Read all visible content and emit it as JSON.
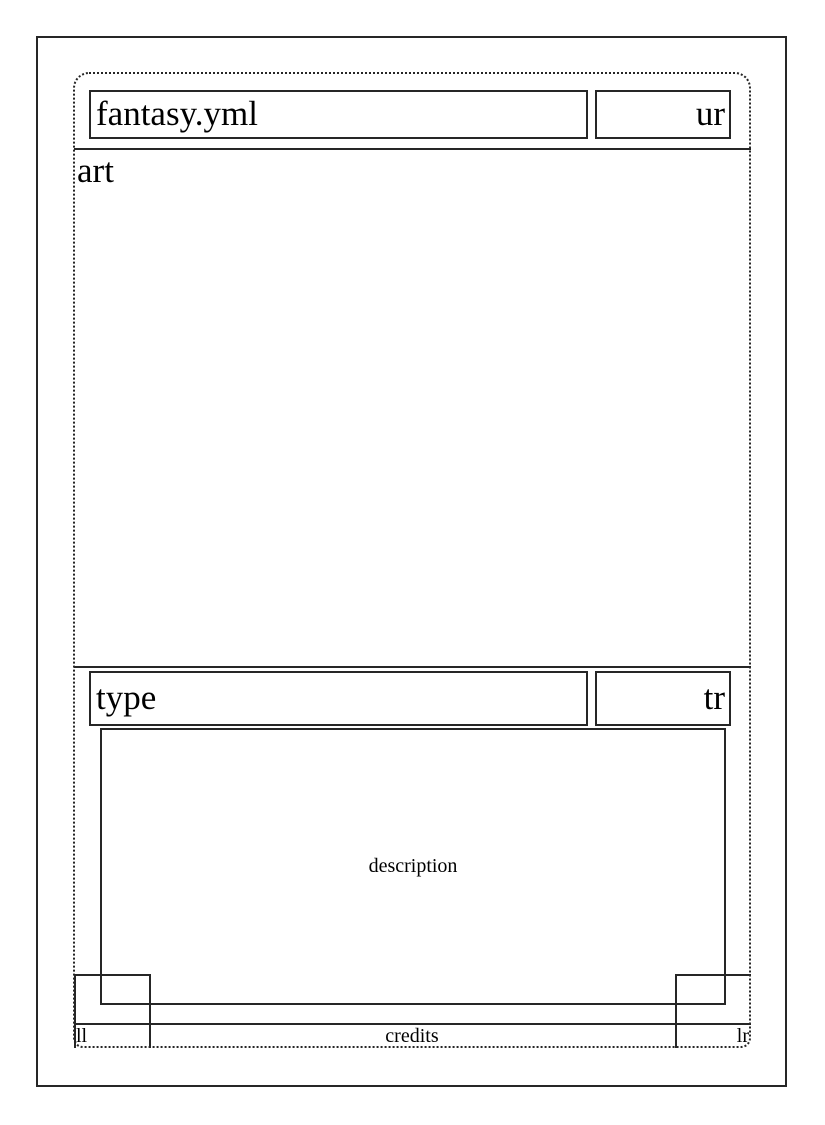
{
  "theme": {
    "background": "#ffffff",
    "line_color": "#262626",
    "text_color": "#000000"
  },
  "slots": {
    "name": "fantasy.yml",
    "upper_right": "ur",
    "art": "art",
    "type_line": "type",
    "type_right": "tr",
    "description": "description",
    "lower_left": "ll",
    "credits": "credits",
    "lower_right": "lr"
  }
}
